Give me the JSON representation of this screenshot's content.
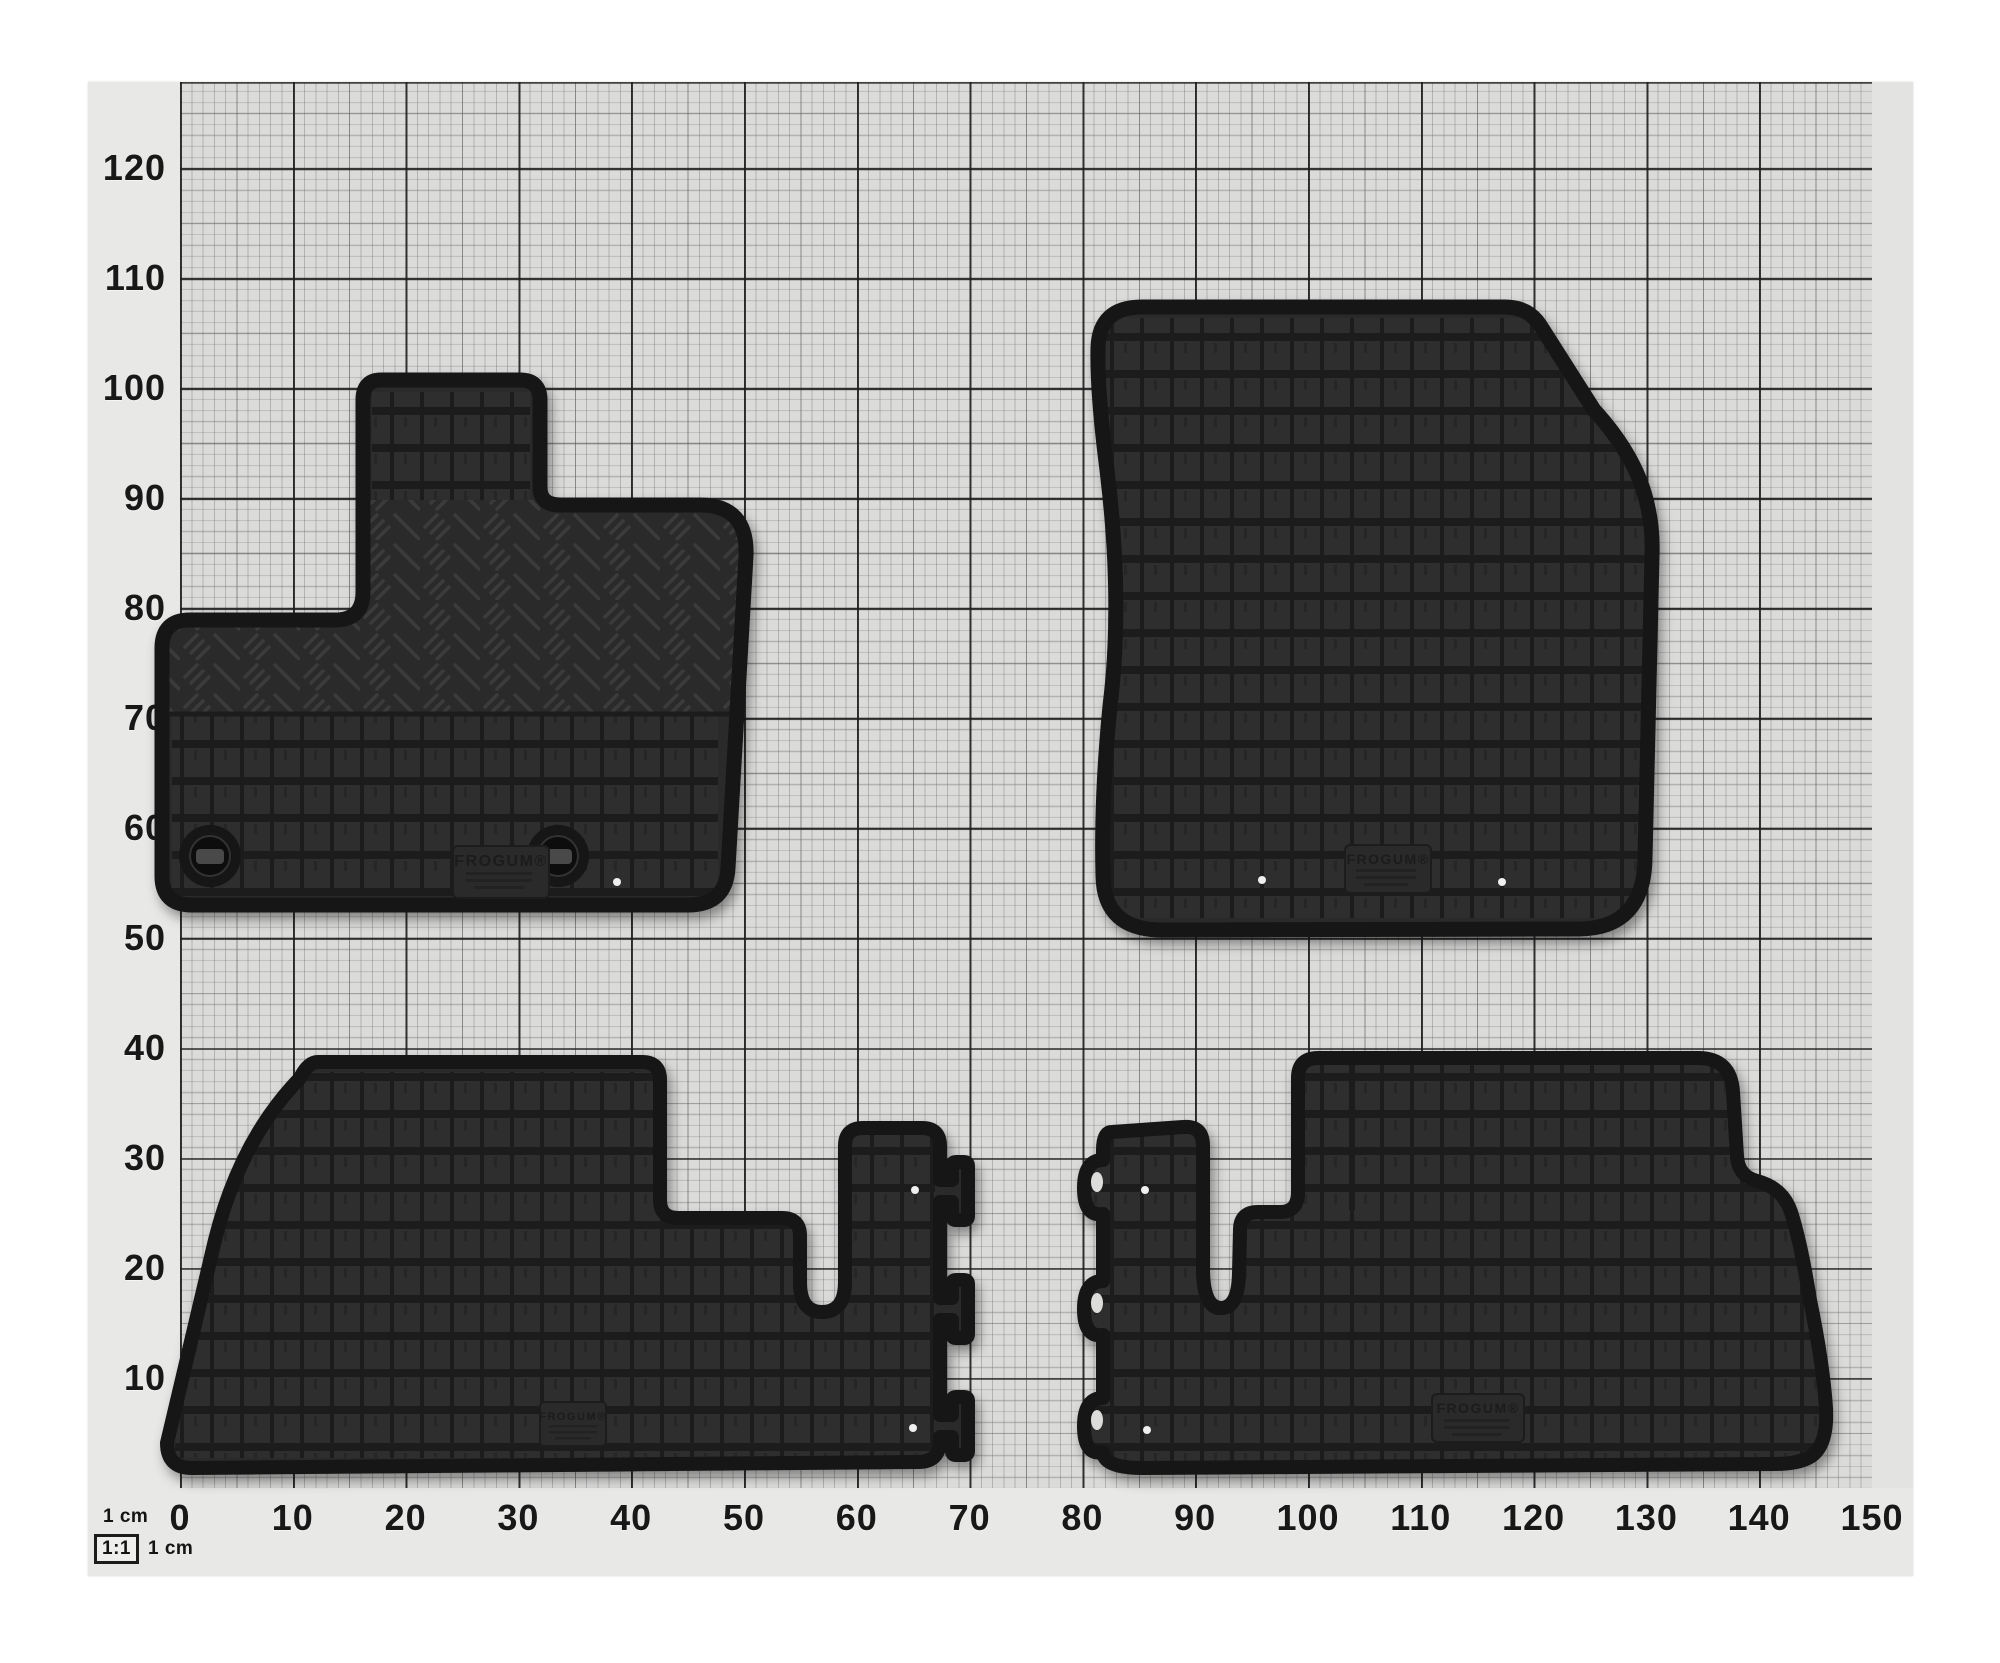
{
  "photo": {
    "description": "four black rubber car floor mats on 1:1 graph paper",
    "colors": {
      "page_background": "#ffffff",
      "paper": "#dbdbda",
      "margin_strip": "#e8e8e7",
      "grid_major": "#1e1e1e",
      "grid_fine": "#6e6e6e",
      "mat_rubber": "#2b2b2b",
      "mat_groove": "#1f1f1f",
      "mat_rim": "#151515"
    },
    "y_axis": {
      "unit": "cm",
      "labels": [
        "120",
        "110",
        "100",
        "90",
        "80",
        "70",
        "60",
        "50",
        "40",
        "30",
        "20",
        "10"
      ]
    },
    "x_axis": {
      "unit": "cm",
      "labels": [
        "0",
        "10",
        "20",
        "30",
        "40",
        "50",
        "60",
        "70",
        "80",
        "90",
        "100",
        "110",
        "120",
        "130",
        "140",
        "150"
      ]
    },
    "scale_legend": {
      "top": "1 cm",
      "ratio": "1:1",
      "side": "1 cm"
    },
    "mats": [
      {
        "name": "front-left-mat",
        "brand": "FROGUM®"
      },
      {
        "name": "front-right-mat",
        "brand": "FROGUM®"
      },
      {
        "name": "rear-left-mat",
        "brand": "FROGUM®"
      },
      {
        "name": "rear-right-mat",
        "brand": "FROGUM®"
      }
    ]
  }
}
